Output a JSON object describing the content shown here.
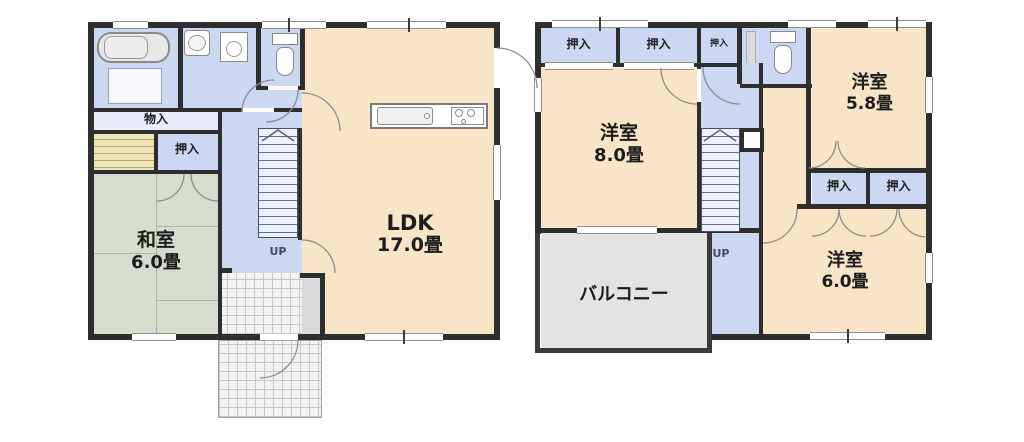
{
  "colors": {
    "wall": "#2e2e2e",
    "room_cream": "#f8e4c6",
    "hall_blue": "#ccd7f1",
    "tatami_green": "#d7dcd0",
    "closet_striped": "#ece5b9",
    "balcony_gray": "#e3e3e3",
    "tile_gray": "#f2f2f2"
  },
  "floor1": {
    "labels": {
      "storage": "物入",
      "closet": "押入",
      "washitsu_name": "和室",
      "washitsu_size": "6.0畳",
      "ldk_name": "LDK",
      "ldk_size": "17.0畳",
      "stairs_up": "UP"
    }
  },
  "floor2": {
    "labels": {
      "closet_top_1": "押入",
      "closet_top_2": "押入",
      "closet_top_3": "押入",
      "closet_mid_1": "押入",
      "closet_mid_2": "押入",
      "room8_name": "洋室",
      "room8_size": "8.0畳",
      "room58_name": "洋室",
      "room58_size": "5.8畳",
      "room6_name": "洋室",
      "room6_size": "6.0畳",
      "balcony": "バルコニー",
      "stairs_up": "UP"
    }
  }
}
